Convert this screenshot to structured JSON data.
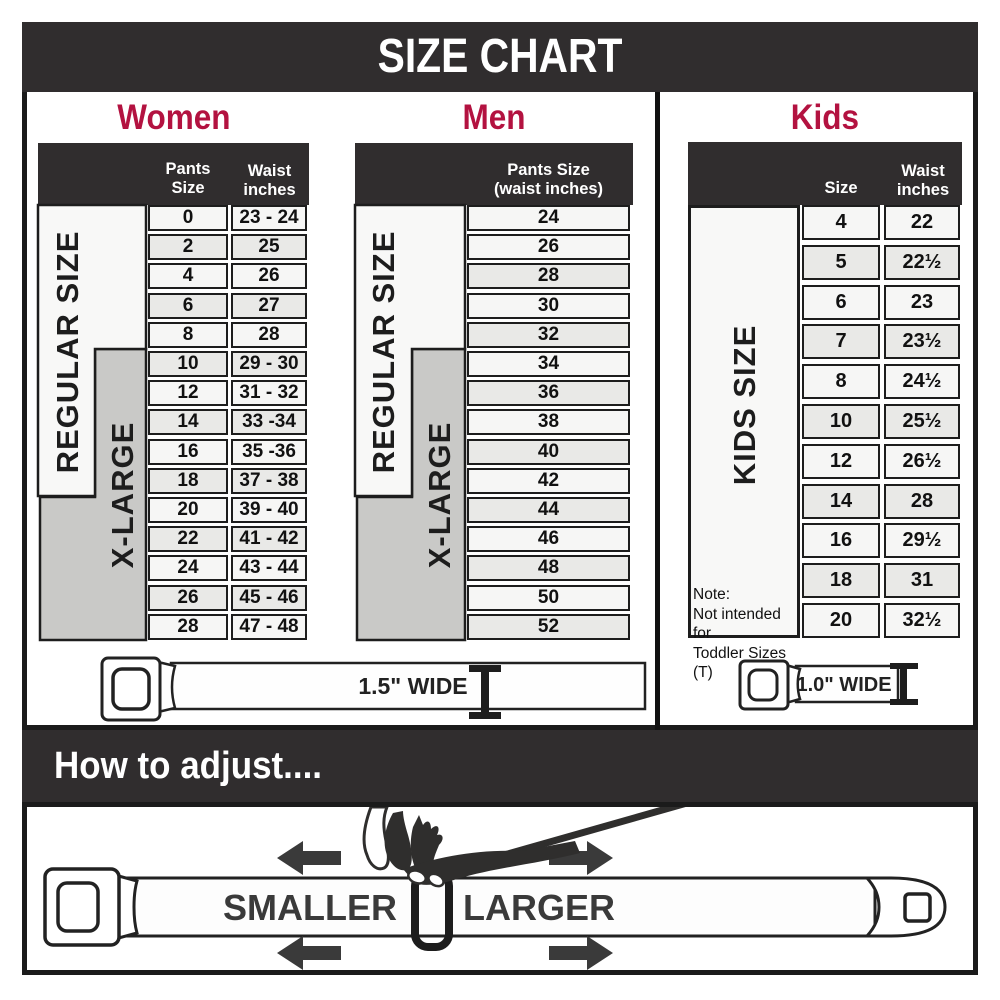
{
  "header": {
    "title": "SIZE CHART"
  },
  "sections": {
    "women": {
      "title": "Women",
      "col1_header": "Pants Size",
      "col2_header_line1": "Waist",
      "col2_header_line2": "inches",
      "regular_label": "REGULAR SIZE",
      "xlarge_label": "X-LARGE",
      "rows": [
        [
          "0",
          "23 - 24"
        ],
        [
          "2",
          "25"
        ],
        [
          "4",
          "26"
        ],
        [
          "6",
          "27"
        ],
        [
          "8",
          "28"
        ],
        [
          "10",
          "29 - 30"
        ],
        [
          "12",
          "31 - 32"
        ],
        [
          "14",
          "33 -34"
        ],
        [
          "16",
          "35 -36"
        ],
        [
          "18",
          "37 - 38"
        ],
        [
          "20",
          "39 - 40"
        ],
        [
          "22",
          "41 - 42"
        ],
        [
          "24",
          "43 - 44"
        ],
        [
          "26",
          "45 - 46"
        ],
        [
          "28",
          "47 - 48"
        ]
      ]
    },
    "men": {
      "title": "Men",
      "col_header_line1": "Pants Size",
      "col_header_line2": "(waist inches)",
      "regular_label": "REGULAR SIZE",
      "xlarge_label": "X-LARGE",
      "rows": [
        "24",
        "26",
        "28",
        "30",
        "32",
        "34",
        "36",
        "38",
        "40",
        "42",
        "44",
        "46",
        "48",
        "50",
        "52"
      ]
    },
    "kids": {
      "title": "Kids",
      "col1_header": "Size",
      "col2_header_line1": "Waist",
      "col2_header_line2": "inches",
      "side_label": "KIDS SIZE",
      "note_line1": "Note:",
      "note_line2": "Not intended for",
      "note_line3": "Toddler Sizes (T)",
      "rows": [
        [
          "4",
          "22"
        ],
        [
          "5",
          "22½"
        ],
        [
          "6",
          "23"
        ],
        [
          "7",
          "23½"
        ],
        [
          "8",
          "24½"
        ],
        [
          "10",
          "25½"
        ],
        [
          "12",
          "26½"
        ],
        [
          "14",
          "28"
        ],
        [
          "16",
          "29½"
        ],
        [
          "18",
          "31"
        ],
        [
          "20",
          "32½"
        ]
      ]
    }
  },
  "belts": {
    "adult_width_label": "1.5\" WIDE",
    "kids_width_label": "1.0\" WIDE"
  },
  "adjust": {
    "title": "How to adjust....",
    "smaller_label": "SMALLER",
    "larger_label": "LARGER"
  },
  "colors": {
    "accent_red": "#b31240",
    "dark_bar": "#302d2e",
    "border_black": "#1b1b1b",
    "row_light": "#f6f6f5",
    "row_gray": "#e9e9e7",
    "xlarge_gray": "#c9c9c7"
  }
}
